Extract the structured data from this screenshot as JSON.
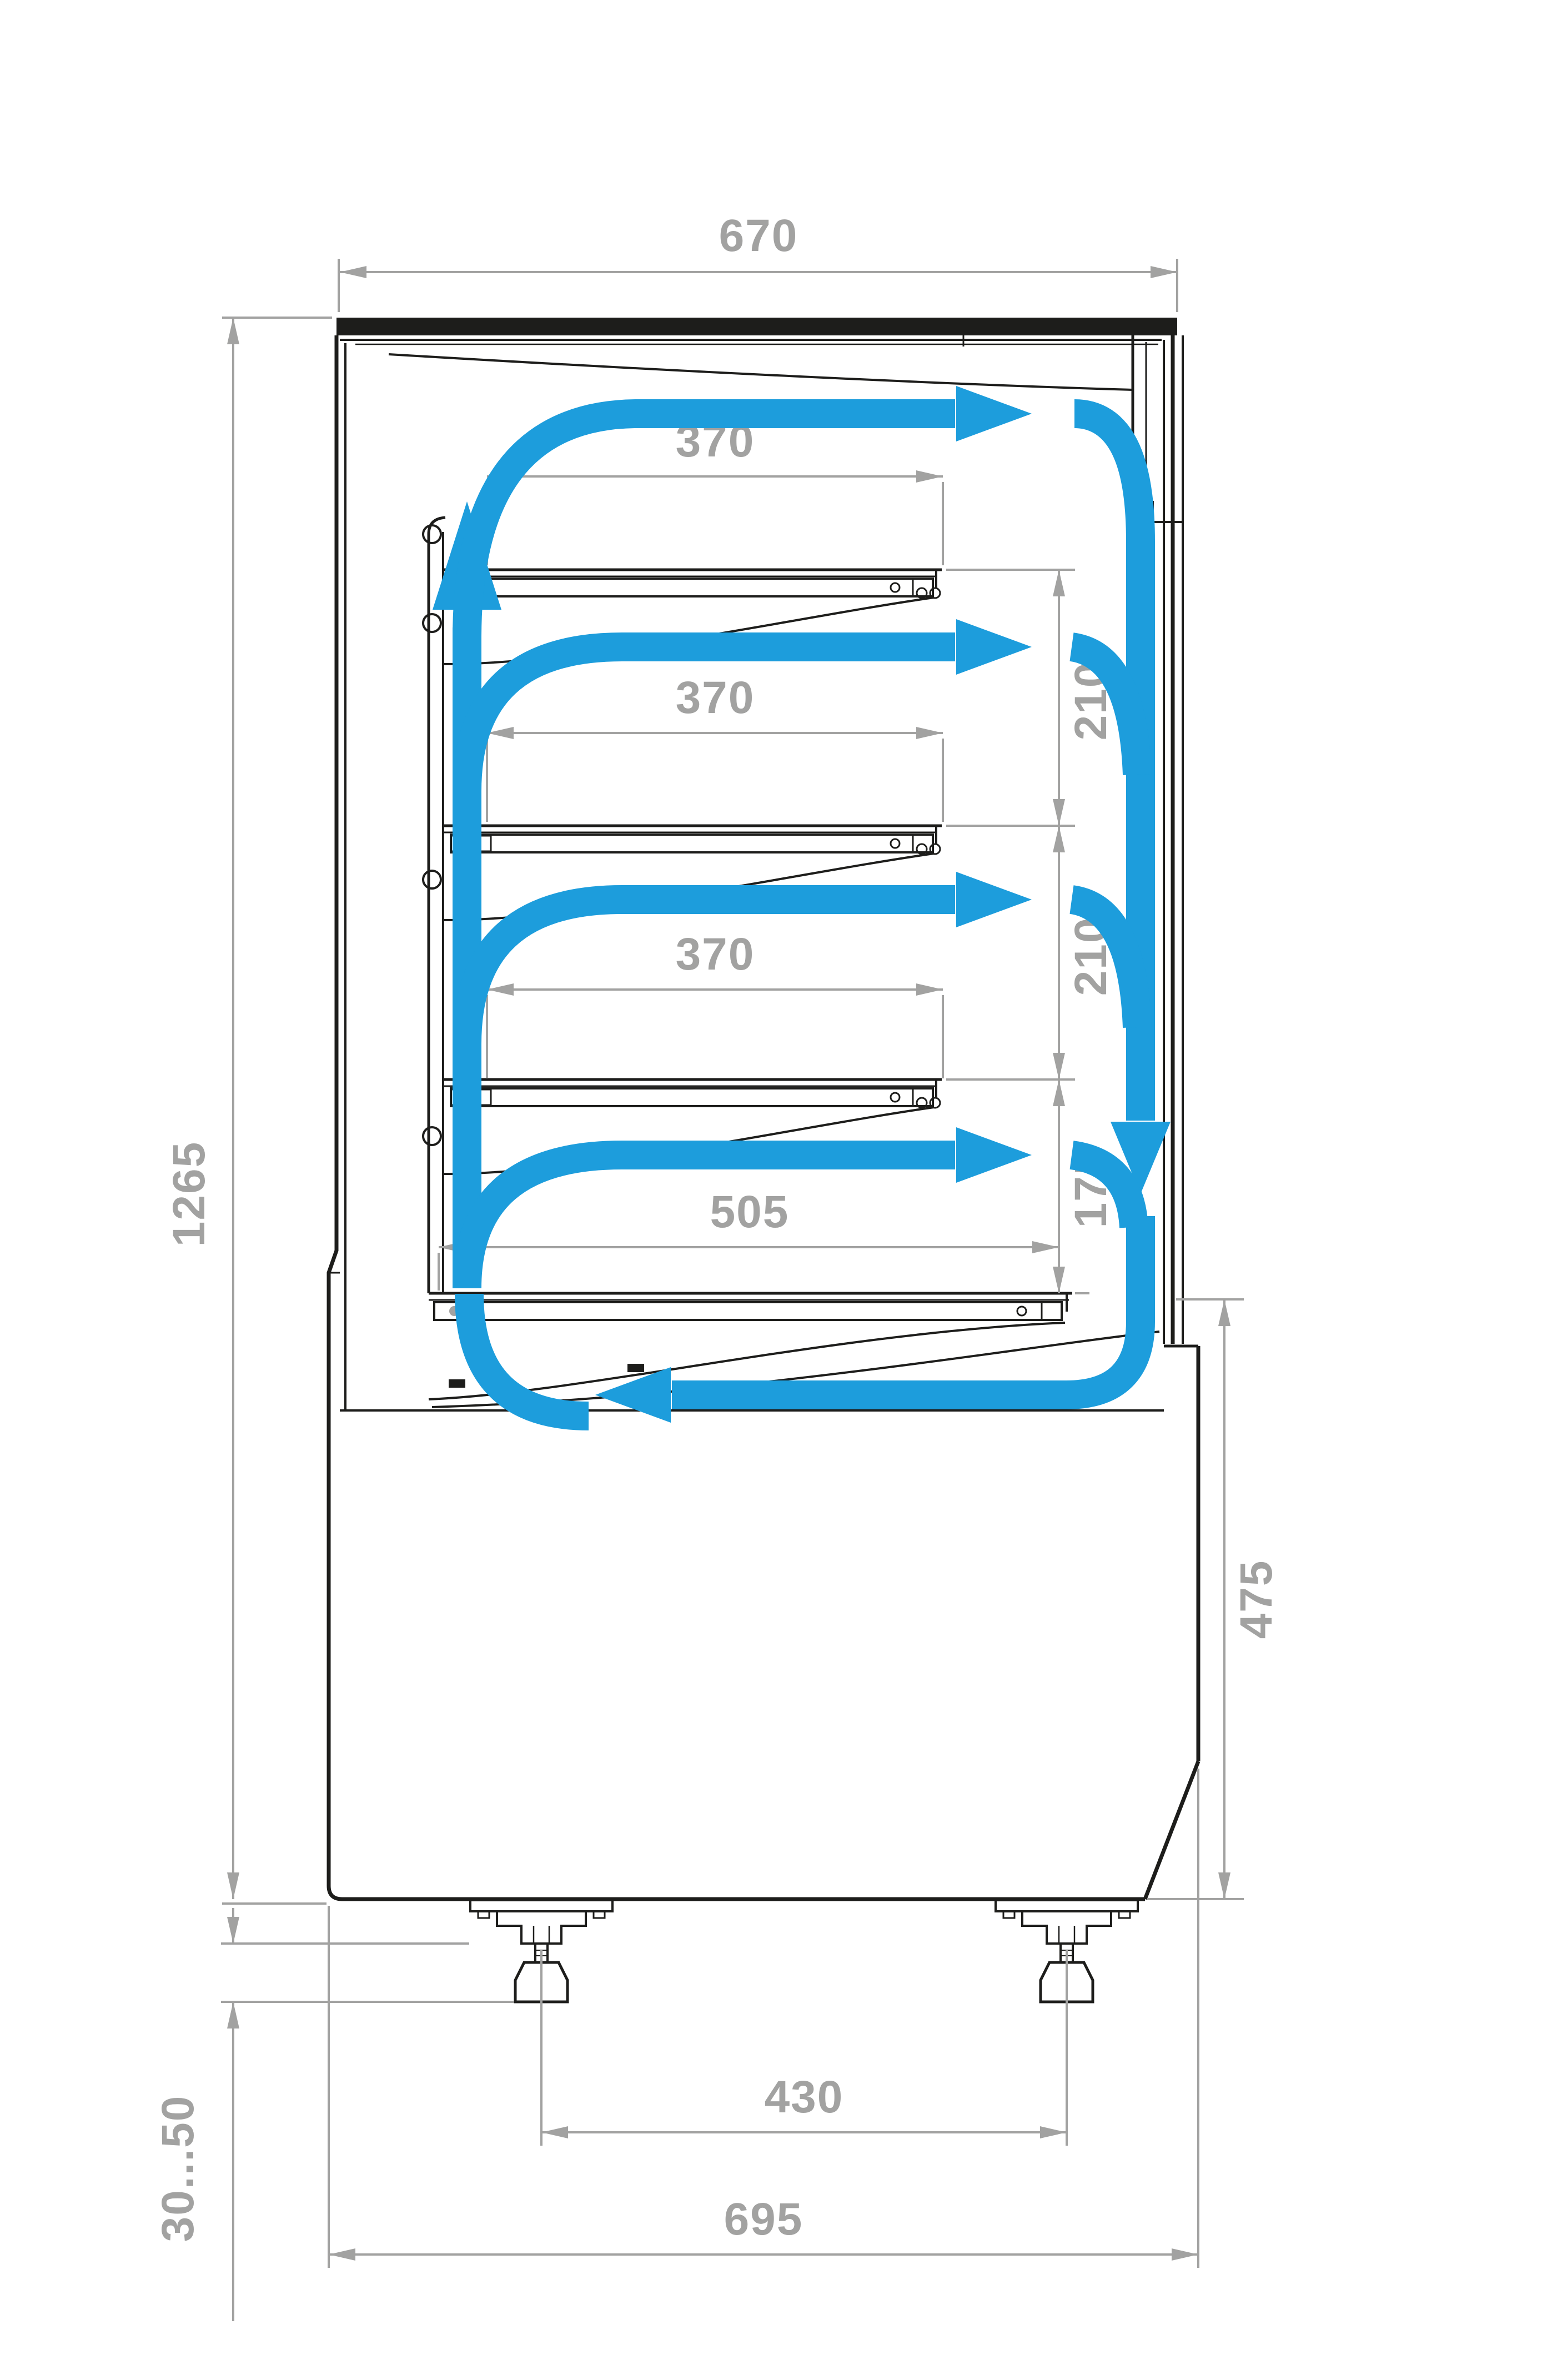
{
  "diagram": {
    "type": "technical-dimension-drawing",
    "subject": "refrigerated display case side cross-section with air circulation flow",
    "units": "mm",
    "colors": {
      "line": "#1D1D1B",
      "dimension": "#A2A2A1",
      "airflow": "#1D9DDC",
      "background": "#ffffff"
    },
    "dims": {
      "top_width": "670",
      "overall_height": "1265",
      "shelf1_length": "370",
      "shelf2_length": "370",
      "shelf3_length": "370",
      "gap_shelf1_shelf2": "210",
      "gap_shelf2_shelf3": "210",
      "gap_shelf3_deck": "175",
      "deck_length": "505",
      "base_height": "475",
      "feet_spacing": "430",
      "base_width": "695",
      "foot_adjust_range": "30...50"
    }
  }
}
